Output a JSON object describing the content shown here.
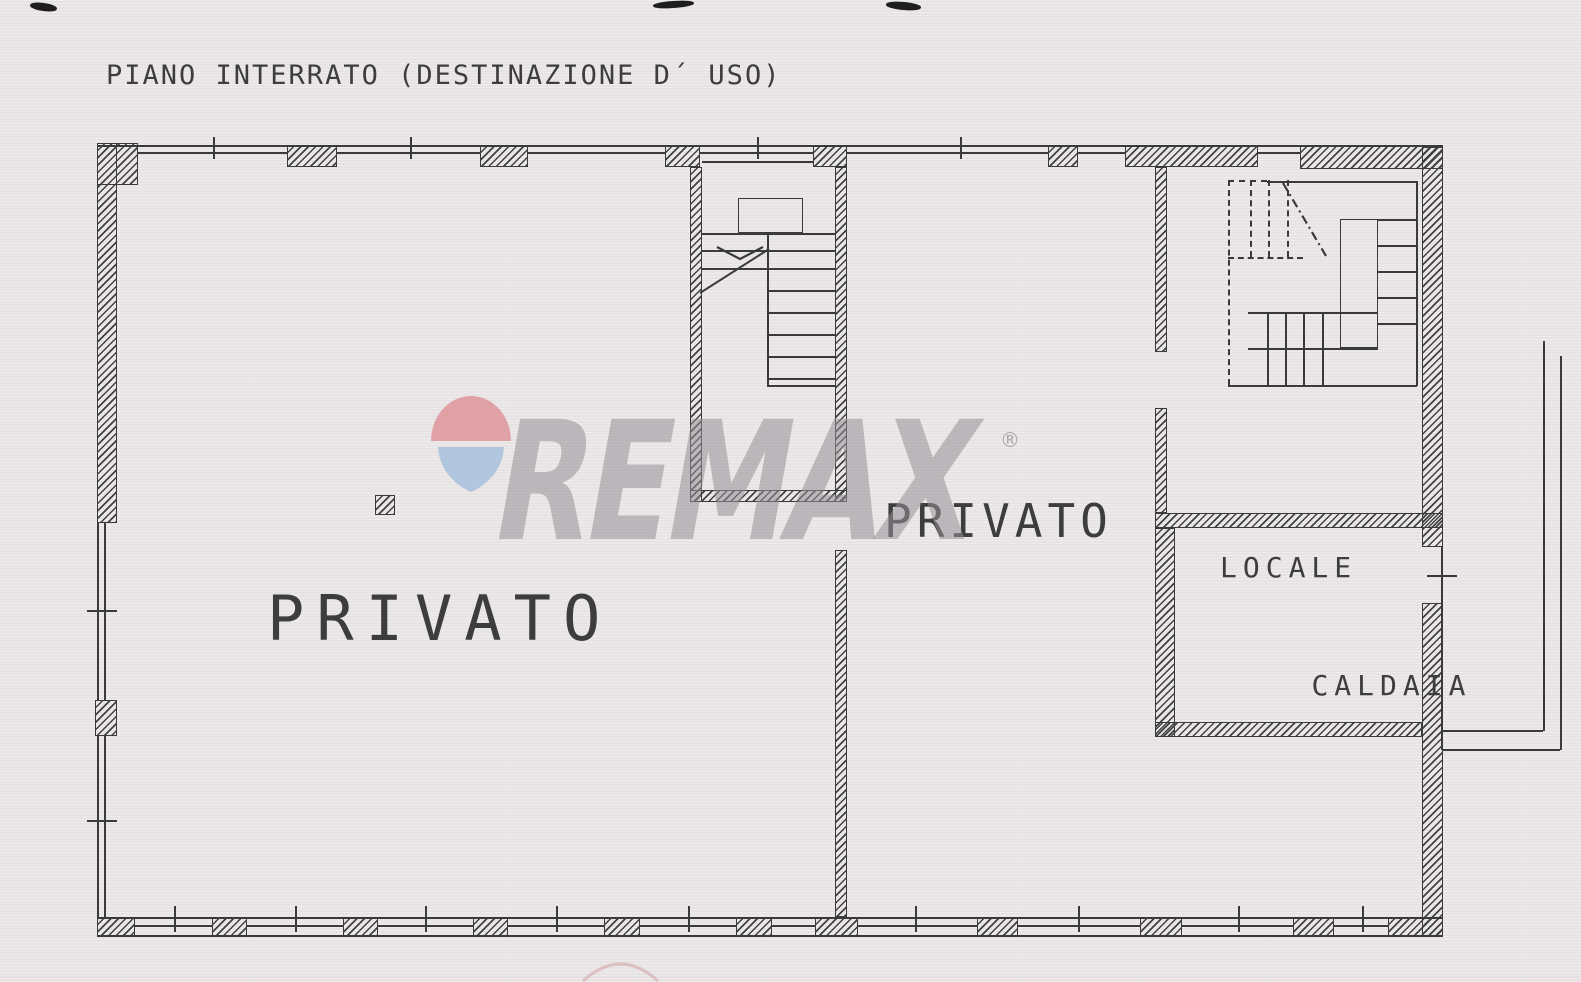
{
  "title": "PIANO INTERRATO (DESTINAZIONE D´ USO)",
  "watermark": {
    "brand": "REMAX",
    "registered": "®"
  },
  "labels": {
    "room_left": "PRIVATO",
    "room_right": "PRIVATO",
    "boiler_room_line1": "LOCALE",
    "boiler_room_line2": "CALDAIA"
  },
  "colors": {
    "paper": "#eae6e7",
    "ink": "#3a3a3a",
    "watermark_gray": "#949096",
    "balloon_red": "#dd9096",
    "balloon_blue": "#a2bddc"
  }
}
